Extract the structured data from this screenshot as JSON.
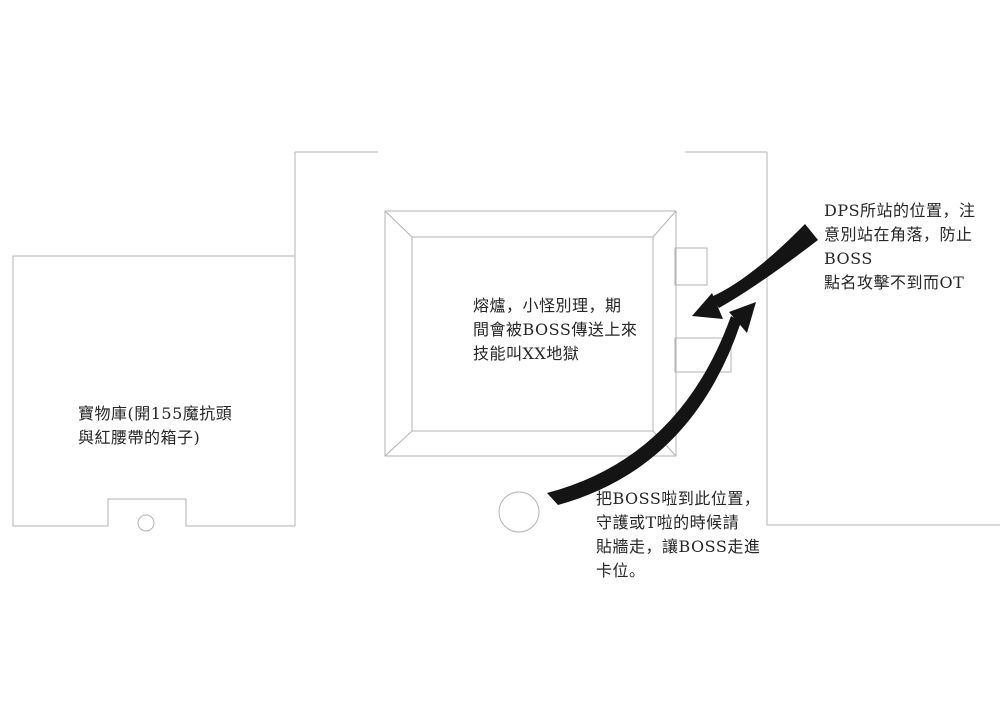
{
  "annotations": {
    "dps": "DPS所站的位置，注\n意別站在角落，防止BOSS\n點名攻擊不到而OT",
    "furnace": "熔爐，小怪別理，期\n間會被BOSS傳送上來\n技能叫XX地獄",
    "vault": "寶物庫(開155魔抗頭\n與紅腰帶的箱子)",
    "boss_position": "把BOSS啦到此位置，\n守護或T啦的時候請\n貼牆走，讓BOSS走進\n卡位。"
  },
  "colors": {
    "wall_line": "#b3b3b3",
    "arrow": "#141414",
    "text": "#262626",
    "background": "#ffffff"
  }
}
